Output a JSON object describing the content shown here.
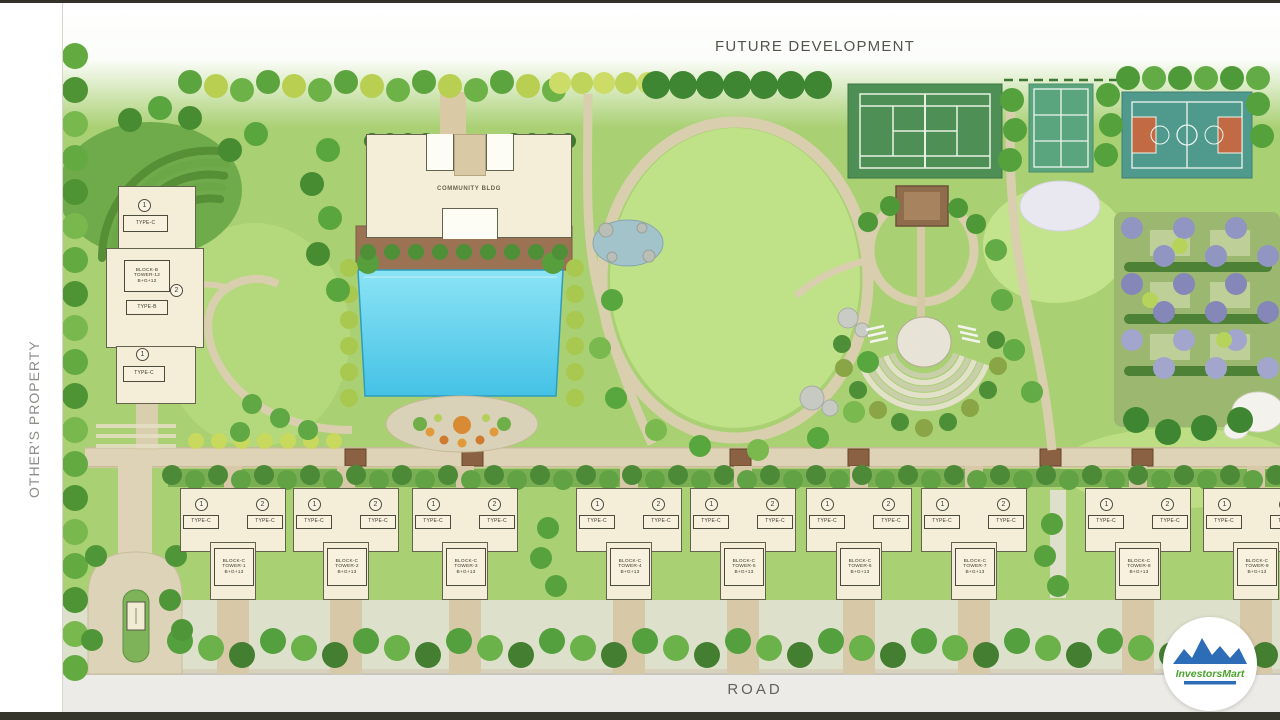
{
  "map": {
    "future_development_label": "FUTURE DEVELOPMENT",
    "others_property_label": "OTHER'S PROPERTY",
    "road_label": "ROAD"
  },
  "community_building": {
    "label": "COMMUNITY BLDG"
  },
  "left_tower": {
    "marker_top": "1",
    "type_top": "TYPE-C",
    "block_lines": [
      "BLOCK-B",
      "TOWER-12",
      "B+G+12"
    ],
    "type_mid": "TYPE-B",
    "path_marker": "2",
    "marker_bottom": "1",
    "type_bottom": "TYPE-C"
  },
  "bottom_buildings": [
    {
      "markers": [
        "1",
        "2"
      ],
      "types": [
        "TYPE-C",
        "TYPE-C"
      ],
      "block_lines": [
        "BLOCK-C",
        "TOWER-1",
        "B+G+13"
      ]
    },
    {
      "markers": [
        "1",
        "2"
      ],
      "types": [
        "TYPE-C",
        "TYPE-C"
      ],
      "block_lines": [
        "BLOCK-C",
        "TOWER-2",
        "B+G+13"
      ]
    },
    {
      "markers": [
        "1",
        "2"
      ],
      "types": [
        "TYPE-C",
        "TYPE-C"
      ],
      "block_lines": [
        "BLOCK-C",
        "TOWER-3",
        "B+G+13"
      ]
    },
    {
      "markers": [
        "1",
        "2"
      ],
      "types": [
        "TYPE-C",
        "TYPE-C"
      ],
      "block_lines": [
        "BLOCK-C",
        "TOWER-4",
        "B+G+13"
      ]
    },
    {
      "markers": [
        "1",
        "2"
      ],
      "types": [
        "TYPE-C",
        "TYPE-C"
      ],
      "block_lines": [
        "BLOCK-C",
        "TOWER-5",
        "B+G+13"
      ]
    },
    {
      "markers": [
        "1",
        "2"
      ],
      "types": [
        "TYPE-C",
        "TYPE-C"
      ],
      "block_lines": [
        "BLOCK-C",
        "TOWER-6",
        "B+G+13"
      ]
    },
    {
      "markers": [
        "1",
        "2"
      ],
      "types": [
        "TYPE-C",
        "TYPE-C"
      ],
      "block_lines": [
        "BLOCK-C",
        "TOWER-7",
        "B+G+13"
      ]
    },
    {
      "markers": [
        "1",
        "2"
      ],
      "types": [
        "TYPE-C",
        "TYPE-C"
      ],
      "block_lines": [
        "BLOCK-C",
        "TOWER-8",
        "B+G+13"
      ]
    },
    {
      "markers": [
        "1",
        "2"
      ],
      "types": [
        "TYPE-C",
        "TYPE-C"
      ],
      "block_lines": [
        "BLOCK-C",
        "TOWER-9",
        "B+G+13"
      ]
    }
  ],
  "logo": {
    "text": "InvestorsMart",
    "mountain_color": "#2d6db8",
    "text_color": "#4ba42c"
  },
  "colors": {
    "pool_blue": "#5fd0ee",
    "lawn_green": "#a9d073",
    "path_tan": "#ded3b6",
    "tennis_court_green": "#4e8f55",
    "basketball_court_teal": "#4f9a8c",
    "court_key_red": "#c26a43",
    "flower_garden_purple": "#9195c2",
    "logo_blue": "#2d6db8",
    "logo_green": "#4ba42c"
  }
}
